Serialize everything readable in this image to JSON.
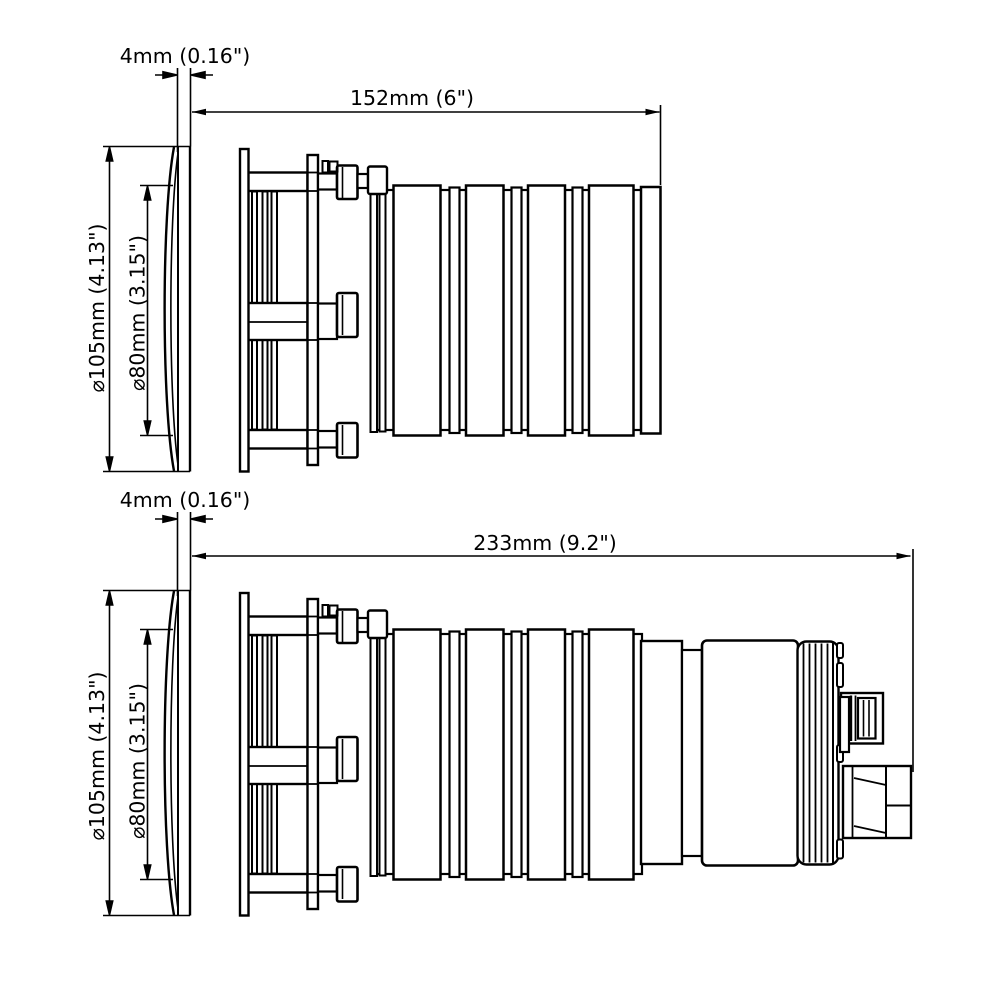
{
  "drawing": {
    "kind": "technical-dimension-drawing",
    "line_color": "#000000",
    "background_color": "#ffffff"
  },
  "views": [
    {
      "name": "short-housing-side-view",
      "labels": {
        "flange_thickness": "4mm (0.16\")",
        "overall_length": "152mm (6\")",
        "outer_diameter": "⌀105mm (4.13\")",
        "body_diameter": "⌀80mm (3.15\")"
      }
    },
    {
      "name": "long-housing-side-view",
      "labels": {
        "flange_thickness": "4mm (0.16\")",
        "overall_length": "233mm (9.2\")",
        "outer_diameter": "⌀105mm (4.13\")",
        "body_diameter": "⌀80mm (3.15\")"
      }
    }
  ]
}
